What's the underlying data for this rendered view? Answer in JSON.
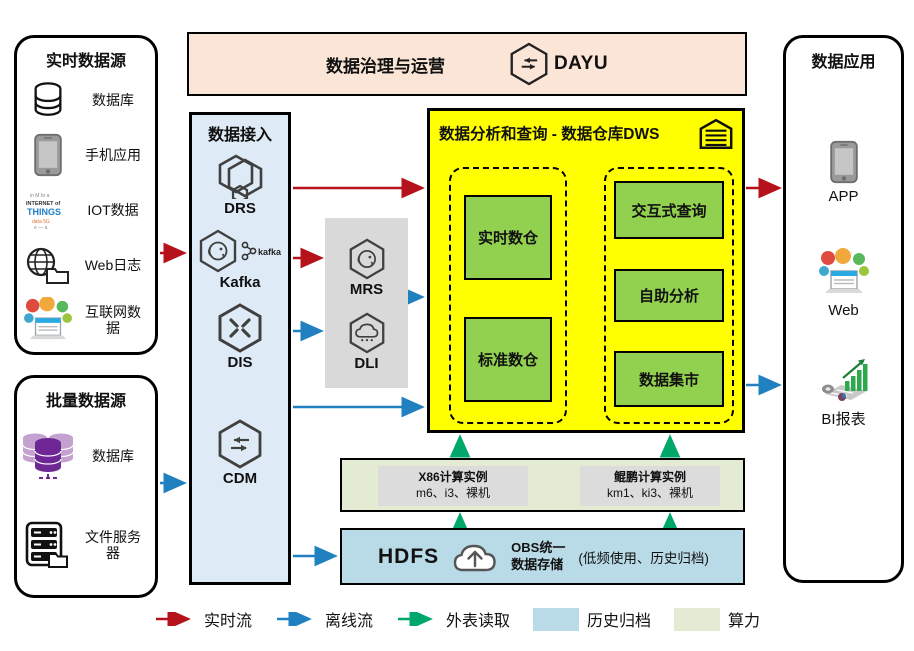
{
  "banner": {
    "title": "数据治理与运营",
    "product": "DAYU"
  },
  "realtime_sources": {
    "title": "实时数据源",
    "items": [
      {
        "label": "数据库"
      },
      {
        "label": "手机应用"
      },
      {
        "label": "IOT数据",
        "icon_words": "INTERNET of THINGS"
      },
      {
        "label": "Web日志"
      },
      {
        "label": "互联网数据"
      }
    ]
  },
  "batch_sources": {
    "title": "批量数据源",
    "items": [
      {
        "label": "数据库"
      },
      {
        "label": "文件服务器"
      }
    ]
  },
  "access": {
    "title": "数据接入",
    "items": [
      {
        "label": "DRS"
      },
      {
        "label": "Kafka",
        "logo_text": "kafka"
      },
      {
        "label": "DIS"
      },
      {
        "label": "CDM"
      }
    ]
  },
  "processing": {
    "items": [
      {
        "label": "MRS"
      },
      {
        "label": "DLI"
      }
    ]
  },
  "dws": {
    "title": "数据分析和查询 - 数据仓库DWS",
    "warehouses": [
      {
        "label": "实时数仓"
      },
      {
        "label": "标准数仓"
      }
    ],
    "services": [
      {
        "label": "交互式查询"
      },
      {
        "label": "自助分析"
      },
      {
        "label": "数据集市"
      }
    ]
  },
  "compute": {
    "instances": [
      {
        "title": "X86计算实例",
        "spec": "m6、i3、裸机"
      },
      {
        "title": "鲲鹏计算实例",
        "spec": "km1、ki3、裸机"
      }
    ]
  },
  "storage": {
    "hdfs_label": "HDFS",
    "obs_line1": "OBS统一",
    "obs_line2": "数据存储",
    "note": "(低频使用、历史归档)"
  },
  "applications": {
    "title": "数据应用",
    "items": [
      {
        "label": "APP"
      },
      {
        "label": "Web"
      },
      {
        "label": "BI报表"
      }
    ]
  },
  "legend": {
    "items": [
      {
        "label": "实时流"
      },
      {
        "label": "离线流"
      },
      {
        "label": "外表读取"
      },
      {
        "label": "历史归档"
      },
      {
        "label": "算力"
      }
    ]
  },
  "colors": {
    "realtime_flow": "#B5121B",
    "offline_flow": "#2180C0",
    "external_read": "#00A76A",
    "history_archive": "#B9DBE7",
    "compute_power": "#E3ECD3",
    "governance_bg": "#FBE5D6",
    "access_bg": "#DEEBF7",
    "dws_bg": "#FFFF00",
    "warehouse_green": "#92D050"
  }
}
